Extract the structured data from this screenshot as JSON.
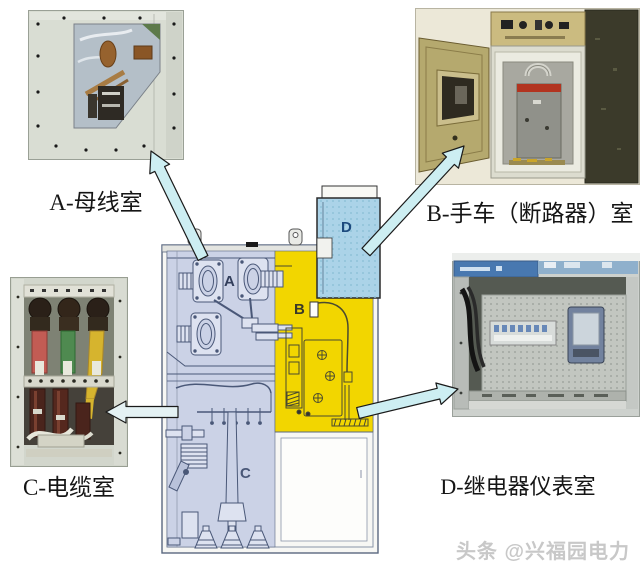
{
  "photos": {
    "a": {
      "label": "A-母线室"
    },
    "b": {
      "label": "B-手车（断路器）室"
    },
    "c": {
      "label": "C-电缆室"
    },
    "d": {
      "label": "D-继电器仪表室"
    }
  },
  "diagram": {
    "letters": {
      "a": "A",
      "b": "B",
      "c": "C",
      "d": "D"
    },
    "colors": {
      "busbar_cable_rooms": "#cbd2e6",
      "breaker_room": "#f2d600",
      "relay_room": "#abd3e8",
      "arrow_fill": "#cdeef2",
      "arrow_fill_light": "#e4f1f3"
    }
  },
  "watermark": {
    "text": "头条 @兴福园电力",
    "color": "#c8c8c8"
  }
}
